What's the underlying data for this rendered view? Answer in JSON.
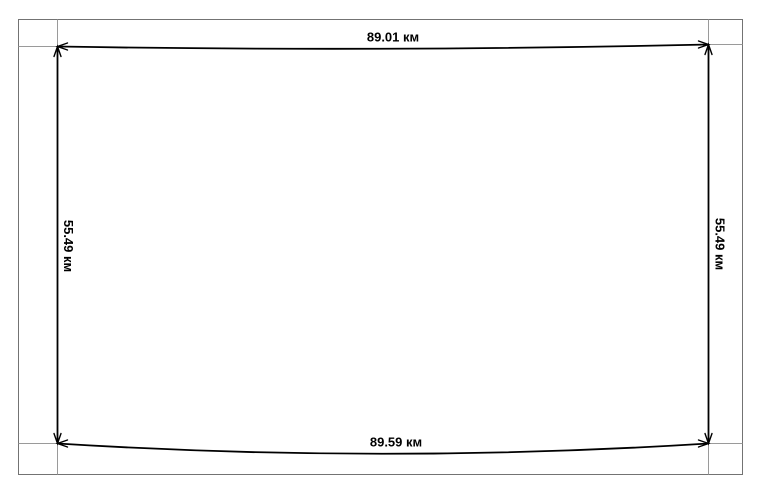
{
  "diagram": {
    "type": "rectangle-with-dimension-lines",
    "unit": "км",
    "labels": {
      "top": "89.01 км",
      "bottom": "89.59 км",
      "left": "55.49 км",
      "right": "55.49 км"
    },
    "measurements": {
      "top_km": 89.01,
      "bottom_km": 89.59,
      "left_km": 55.49,
      "right_km": 55.49
    },
    "colors": {
      "dimension_line": "#000000",
      "label_text": "#000000",
      "extension_line": "#9a9a9a",
      "frame_border": "#737373",
      "background": "#ffffff"
    }
  }
}
